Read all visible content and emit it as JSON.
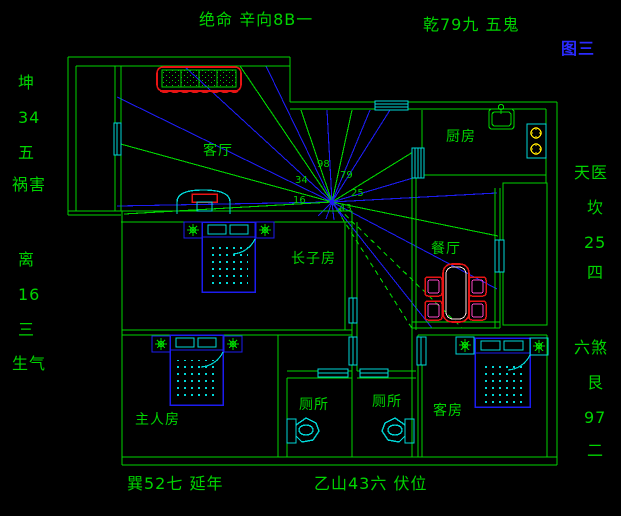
{
  "figure_title": "图三",
  "colors": {
    "green": "#00d400",
    "blue": "#1c1cf0",
    "cyan": "#00d8d8",
    "red": "#e81414",
    "magenta": "#ff48c8",
    "yellow": "#ffe400",
    "white": "#ffe0e0",
    "label_blue": "#2a2aff",
    "background": "#000000"
  },
  "perimeter_labels": [
    {
      "id": "top-center",
      "text": "绝命 辛向8B一",
      "x": 199,
      "y": 12,
      "color": "green"
    },
    {
      "id": "top-right",
      "text": "乾79九 五鬼",
      "x": 423,
      "y": 17,
      "color": "green"
    },
    {
      "id": "figure-tag",
      "text": "图三",
      "x": 561,
      "y": 41,
      "color": "label_blue"
    },
    {
      "id": "left-kun",
      "text": "坤",
      "x": 18,
      "y": 75,
      "color": "green"
    },
    {
      "id": "left-34",
      "text": "34",
      "x": 18,
      "y": 110,
      "color": "green"
    },
    {
      "id": "left-wu",
      "text": "五",
      "x": 18,
      "y": 145,
      "color": "green"
    },
    {
      "id": "left-huohai",
      "text": "祸害",
      "x": 12,
      "y": 177,
      "color": "green"
    },
    {
      "id": "left-li",
      "text": "离",
      "x": 18,
      "y": 252,
      "color": "green"
    },
    {
      "id": "left-16",
      "text": "16",
      "x": 18,
      "y": 287,
      "color": "green"
    },
    {
      "id": "left-san",
      "text": "三",
      "x": 18,
      "y": 322,
      "color": "green"
    },
    {
      "id": "left-shengqi",
      "text": "生气",
      "x": 12,
      "y": 356,
      "color": "green"
    },
    {
      "id": "right-tianyi",
      "text": "天医",
      "x": 574,
      "y": 165,
      "color": "green"
    },
    {
      "id": "right-kan",
      "text": "坎",
      "x": 587,
      "y": 200,
      "color": "green"
    },
    {
      "id": "right-25",
      "text": "25",
      "x": 584,
      "y": 235,
      "color": "green"
    },
    {
      "id": "right-si",
      "text": "四",
      "x": 587,
      "y": 265,
      "color": "green"
    },
    {
      "id": "right-liusha",
      "text": "六煞",
      "x": 574,
      "y": 340,
      "color": "green"
    },
    {
      "id": "right-gen",
      "text": "艮",
      "x": 587,
      "y": 375,
      "color": "green"
    },
    {
      "id": "right-97",
      "text": "97",
      "x": 584,
      "y": 410,
      "color": "green"
    },
    {
      "id": "right-er",
      "text": "二",
      "x": 587,
      "y": 443,
      "color": "green"
    },
    {
      "id": "bottom-left",
      "text": "巽52七 延年",
      "x": 127,
      "y": 476,
      "color": "green"
    },
    {
      "id": "bottom-center",
      "text": "乙山43六 伏位",
      "x": 314,
      "y": 476,
      "color": "green"
    }
  ],
  "room_labels": [
    {
      "id": "living-room",
      "text": "客厅",
      "x": 203,
      "y": 144
    },
    {
      "id": "kitchen",
      "text": "厨房",
      "x": 446,
      "y": 130
    },
    {
      "id": "eldest-son-room",
      "text": "长子房",
      "x": 291,
      "y": 252
    },
    {
      "id": "dining-room",
      "text": "餐厅",
      "x": 431,
      "y": 242
    },
    {
      "id": "master-room",
      "text": "主人房",
      "x": 135,
      "y": 413
    },
    {
      "id": "toilet-1",
      "text": "厕所",
      "x": 299,
      "y": 398
    },
    {
      "id": "toilet-2",
      "text": "厕所",
      "x": 372,
      "y": 395
    },
    {
      "id": "guest-room",
      "text": "客房",
      "x": 433,
      "y": 404
    }
  ],
  "compass": {
    "center": {
      "x": 332,
      "y": 202
    },
    "numbers": [
      {
        "text": "98",
        "x": 317,
        "y": 160
      },
      {
        "text": "79",
        "x": 340,
        "y": 171
      },
      {
        "text": "34",
        "x": 295,
        "y": 176
      },
      {
        "text": "25",
        "x": 351,
        "y": 189
      },
      {
        "text": "16",
        "x": 293,
        "y": 196
      },
      {
        "text": "43",
        "x": 339,
        "y": 204
      }
    ],
    "rays": [
      {
        "color": "blue",
        "x": 117,
        "y": 97
      },
      {
        "color": "green",
        "x": 117,
        "y": 143
      },
      {
        "color": "blue",
        "x": 117,
        "y": 206
      },
      {
        "color": "green",
        "x": 124,
        "y": 214
      },
      {
        "color": "blue",
        "x": 184,
        "y": 66
      },
      {
        "color": "green",
        "x": 240,
        "y": 66
      },
      {
        "color": "blue",
        "x": 266,
        "y": 66
      },
      {
        "color": "green",
        "x": 301,
        "y": 110
      },
      {
        "color": "blue",
        "x": 327,
        "y": 110
      },
      {
        "color": "green",
        "x": 352,
        "y": 110
      },
      {
        "color": "blue",
        "x": 370,
        "y": 110
      },
      {
        "color": "blue",
        "x": 390,
        "y": 110
      },
      {
        "color": "green",
        "x": 413,
        "y": 152
      },
      {
        "color": "blue",
        "x": 413,
        "y": 178
      },
      {
        "color": "blue",
        "x": 497,
        "y": 193
      },
      {
        "color": "green",
        "x": 498,
        "y": 236
      },
      {
        "color": "blue",
        "x": 497,
        "y": 289
      },
      {
        "color": "green",
        "x": 462,
        "y": 328,
        "dashed": true
      },
      {
        "color": "blue",
        "x": 432,
        "y": 328
      },
      {
        "color": "green",
        "x": 413,
        "y": 330,
        "dashed": true
      },
      {
        "color": "blue",
        "x": 318,
        "y": 216
      },
      {
        "color": "blue",
        "x": 326,
        "y": 219
      },
      {
        "color": "blue",
        "x": 334,
        "y": 220
      },
      {
        "color": "blue",
        "x": 342,
        "y": 217
      }
    ]
  }
}
